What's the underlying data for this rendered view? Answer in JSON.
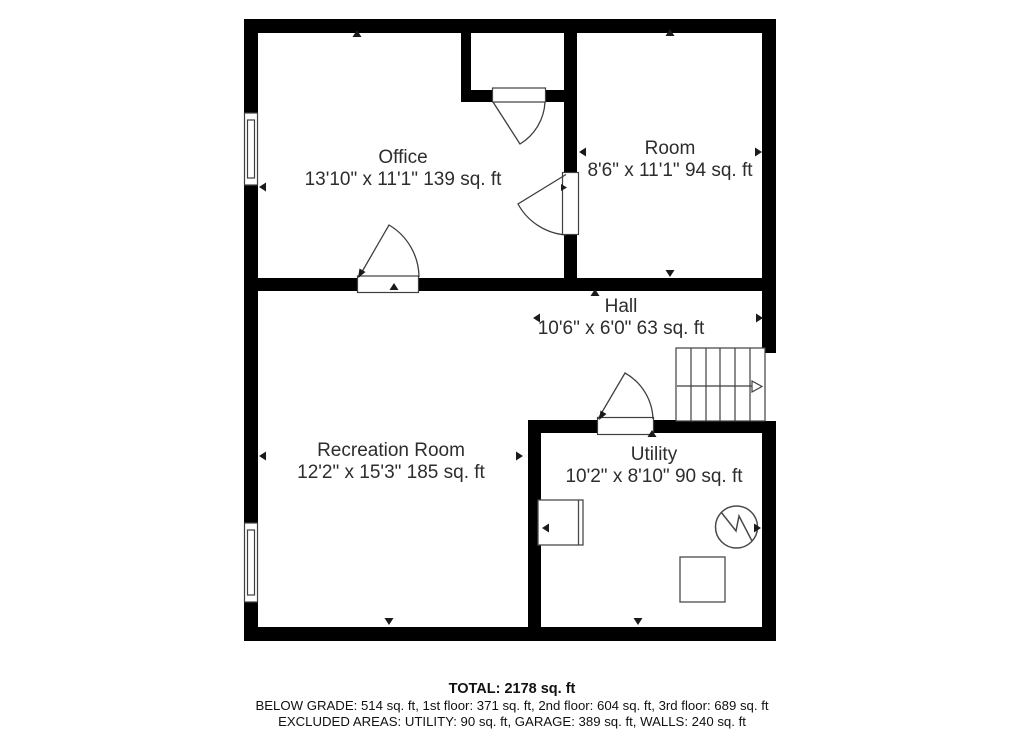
{
  "plan": {
    "rooms": [
      {
        "id": "office",
        "name": "Office",
        "dims": "13'10\" x 11'1\" 139 sq. ft"
      },
      {
        "id": "room",
        "name": "Room",
        "dims": "8'6\" x 11'1\" 94 sq. ft"
      },
      {
        "id": "hall",
        "name": "Hall",
        "dims": "10'6\" x 6'0\" 63 sq. ft"
      },
      {
        "id": "recreation",
        "name": "Recreation Room",
        "dims": "12'2\" x 15'3\" 185 sq. ft"
      },
      {
        "id": "utility",
        "name": "Utility",
        "dims": "10'2\" x 8'10\" 90 sq. ft"
      }
    ],
    "symbols": [
      "door-swing",
      "window",
      "stairs-with-direction-arrow",
      "water-heater",
      "appliance",
      "storage-box",
      "dimension-tick"
    ],
    "colors": {
      "wall": "#000000",
      "symbol_line": "#3f3f3f",
      "label_text": "#2d2d2d",
      "footer_text": "#111111",
      "background": "#ffffff"
    }
  },
  "footer": {
    "total": "TOTAL: 2178 sq. ft",
    "floors": "BELOW GRADE: 514 sq. ft, 1st floor: 371 sq. ft, 2nd floor: 604 sq. ft, 3rd floor: 689 sq. ft",
    "excluded": "EXCLUDED AREAS: UTILITY: 90 sq. ft, GARAGE: 389 sq. ft, WALLS: 240 sq. ft"
  }
}
